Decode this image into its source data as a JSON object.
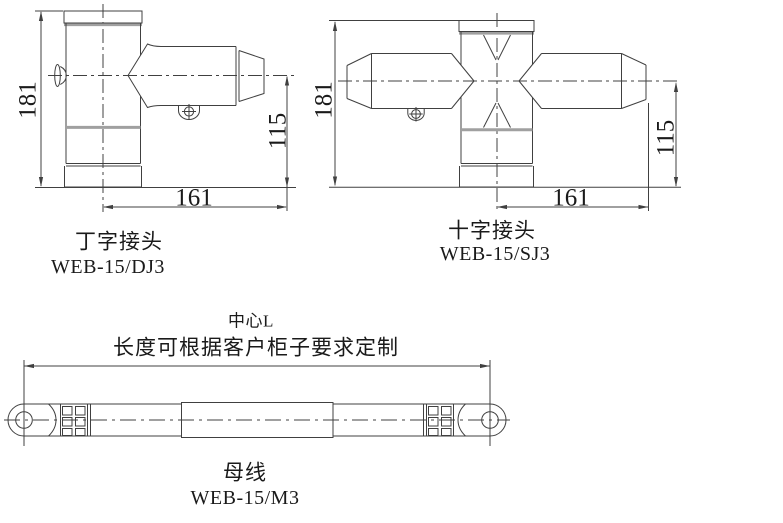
{
  "colors": {
    "background": "#ffffff",
    "line": "#404040",
    "band": "#a0a0a0",
    "text": "#1a1a1a"
  },
  "tee_joint": {
    "caption": "丁字接头",
    "model": "WEB-15/DJ3",
    "dim_total_height": "181",
    "dim_center_height": "115",
    "dim_arm_length": "161"
  },
  "cross_joint": {
    "caption": "十字接头",
    "model": "WEB-15/SJ3",
    "dim_total_height": "181",
    "dim_center_height": "115",
    "dim_arm_length": "161"
  },
  "busbar": {
    "caption": "母线",
    "model": "WEB-15/M3",
    "dim_line1": "中心L",
    "dim_line2": "长度可根据客户柜子要求定制"
  }
}
